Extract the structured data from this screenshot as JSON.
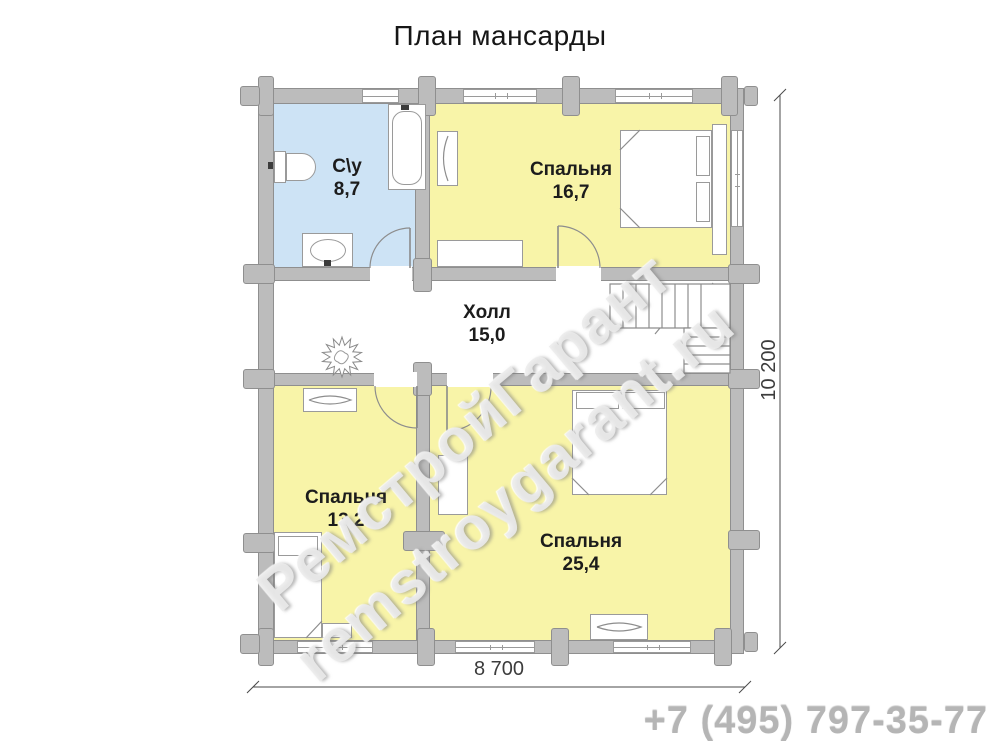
{
  "meta": {
    "title": "План мансарды",
    "phone": "+7 (495) 797-35-77"
  },
  "watermark": {
    "line1": "РемстройГарант",
    "line2": "remstroygarant.ru"
  },
  "dims": {
    "bottom": "8 700",
    "right": "10 200"
  },
  "palette": {
    "bath": "#cde3f5",
    "bedroom": "#f8f4a8",
    "hall": "#ffffff",
    "wall": "#bcbcbc",
    "wall_edge": "#8f8f8f",
    "line": "#8d8d8d",
    "dim": "#4a4a4a",
    "label": "#1c1c1c"
  },
  "floorplan": {
    "rooms": [
      {
        "name": "bathroom",
        "label": "С\\у",
        "area": "8,7",
        "x": 274,
        "y": 104,
        "w": 141,
        "h": 163,
        "fill": "bath",
        "lx": 347,
        "ly": 155
      },
      {
        "name": "bedroom-top",
        "label": "Спальня",
        "area": "16,7",
        "x": 430,
        "y": 104,
        "w": 300,
        "h": 163,
        "fill": "bedroom",
        "lx": 571,
        "ly": 158
      },
      {
        "name": "hall",
        "label": "Холл",
        "area": "15,0",
        "x": 274,
        "y": 281,
        "w": 456,
        "h": 92,
        "fill": "hall",
        "lx": 487,
        "ly": 301
      },
      {
        "name": "bedroom-left",
        "label": "Спальня",
        "area": "13,2",
        "x": 274,
        "y": 386,
        "w": 142,
        "h": 254,
        "fill": "bedroom",
        "lx": 346,
        "ly": 486
      },
      {
        "name": "bedroom-big",
        "label": "Спальня",
        "area": "25,4",
        "x": 430,
        "y": 386,
        "w": 300,
        "h": 254,
        "fill": "bedroom",
        "lx": 581,
        "ly": 530
      }
    ],
    "walls": [
      {
        "name": "wall-top",
        "x": 258,
        "y": 88,
        "w": 486,
        "h": 16
      },
      {
        "name": "wall-bottom",
        "x": 258,
        "y": 640,
        "w": 486,
        "h": 14
      },
      {
        "name": "wall-left",
        "x": 258,
        "y": 88,
        "w": 16,
        "h": 566
      },
      {
        "name": "wall-right",
        "x": 730,
        "y": 88,
        "w": 14,
        "h": 566
      },
      {
        "name": "wall-hall-top",
        "x": 274,
        "y": 267,
        "w": 456,
        "h": 14
      },
      {
        "name": "wall-hall-bottom",
        "x": 274,
        "y": 373,
        "w": 456,
        "h": 13
      },
      {
        "name": "wall-divider-top",
        "x": 415,
        "y": 104,
        "w": 15,
        "h": 163
      },
      {
        "name": "wall-divider-bottom",
        "x": 416,
        "y": 386,
        "w": 14,
        "h": 254
      }
    ],
    "crosses": [
      {
        "x": 258,
        "y": 76,
        "w": 16,
        "h": 40
      },
      {
        "x": 240,
        "y": 86,
        "w": 20,
        "h": 20
      },
      {
        "x": 418,
        "y": 76,
        "w": 18,
        "h": 40
      },
      {
        "x": 562,
        "y": 76,
        "w": 18,
        "h": 40
      },
      {
        "x": 721,
        "y": 76,
        "w": 17,
        "h": 40
      },
      {
        "x": 744,
        "y": 86,
        "w": 14,
        "h": 20
      },
      {
        "x": 243,
        "y": 264,
        "w": 32,
        "h": 20
      },
      {
        "x": 243,
        "y": 369,
        "w": 32,
        "h": 20
      },
      {
        "x": 243,
        "y": 533,
        "w": 32,
        "h": 20
      },
      {
        "x": 728,
        "y": 264,
        "w": 32,
        "h": 20
      },
      {
        "x": 728,
        "y": 369,
        "w": 32,
        "h": 20
      },
      {
        "x": 728,
        "y": 530,
        "w": 32,
        "h": 20
      },
      {
        "x": 413,
        "y": 258,
        "w": 19,
        "h": 34
      },
      {
        "x": 413,
        "y": 362,
        "w": 19,
        "h": 34
      },
      {
        "x": 403,
        "y": 531,
        "w": 42,
        "h": 20
      },
      {
        "x": 258,
        "y": 628,
        "w": 16,
        "h": 38
      },
      {
        "x": 240,
        "y": 634,
        "w": 20,
        "h": 20
      },
      {
        "x": 417,
        "y": 628,
        "w": 18,
        "h": 38
      },
      {
        "x": 551,
        "y": 628,
        "w": 18,
        "h": 38
      },
      {
        "x": 714,
        "y": 628,
        "w": 18,
        "h": 38
      },
      {
        "x": 744,
        "y": 632,
        "w": 14,
        "h": 20
      }
    ],
    "windows": [
      {
        "name": "window-top-bathroom",
        "x": 362,
        "y": 89,
        "w": 37,
        "h": 14
      },
      {
        "name": "window-top-bedroom-1",
        "x": 463,
        "y": 89,
        "w": 74,
        "h": 14
      },
      {
        "name": "window-top-bedroom-2",
        "x": 615,
        "y": 89,
        "w": 78,
        "h": 14
      },
      {
        "name": "window-right-bedroom",
        "x": 731,
        "y": 130,
        "w": 12,
        "h": 97
      },
      {
        "name": "window-bottom-left",
        "x": 297,
        "y": 641,
        "w": 76,
        "h": 12
      },
      {
        "name": "window-bottom-big-1",
        "x": 455,
        "y": 641,
        "w": 80,
        "h": 12
      },
      {
        "name": "window-bottom-big-2",
        "x": 613,
        "y": 641,
        "w": 78,
        "h": 12
      }
    ],
    "door_openings": [
      {
        "name": "bathroom-door-opening",
        "x": 370,
        "y": 266,
        "w": 42,
        "h": 16
      },
      {
        "name": "bedroom-top-door-opening",
        "x": 556,
        "y": 266,
        "w": 45,
        "h": 16
      },
      {
        "name": "bedroom-left-door-opening",
        "x": 374,
        "y": 372,
        "w": 43,
        "h": 15
      },
      {
        "name": "bedroom-big-door-opening",
        "x": 447,
        "y": 372,
        "w": 46,
        "h": 15
      }
    ],
    "furniture": [
      {
        "name": "toilet-tank",
        "x": 274,
        "y": 151,
        "w": 12,
        "h": 32
      },
      {
        "name": "toilet-bowl",
        "x": 286,
        "y": 153,
        "w": 30,
        "h": 28,
        "cls": "round-right"
      },
      {
        "name": "toilet-valve",
        "x": 268,
        "y": 162,
        "w": 5,
        "h": 7,
        "cls": "dark"
      },
      {
        "name": "bathtub",
        "x": 388,
        "y": 104,
        "w": 38,
        "h": 86
      },
      {
        "name": "bathtub-inner",
        "x": 392,
        "y": 111,
        "w": 30,
        "h": 74,
        "cls": "rounded"
      },
      {
        "name": "bathtub-tap",
        "x": 401,
        "y": 105,
        "w": 8,
        "h": 5,
        "cls": "dark"
      },
      {
        "name": "sink-cabinet",
        "x": 302,
        "y": 233,
        "w": 51,
        "h": 34
      },
      {
        "name": "sink-bowl",
        "x": 310,
        "y": 239,
        "w": 36,
        "h": 23,
        "cls": "ellipse"
      },
      {
        "name": "sink-tap",
        "x": 324,
        "y": 260,
        "w": 7,
        "h": 6,
        "cls": "dark"
      },
      {
        "name": "bedroom-top-dresser",
        "x": 437,
        "y": 131,
        "w": 21,
        "h": 55
      },
      {
        "name": "bedroom-top-cabinet",
        "x": 437,
        "y": 240,
        "w": 86,
        "h": 27
      },
      {
        "name": "bedroom-top-bed",
        "x": 620,
        "y": 130,
        "w": 92,
        "h": 98
      },
      {
        "name": "bedroom-top-pillow-1",
        "x": 696,
        "y": 136,
        "w": 14,
        "h": 40
      },
      {
        "name": "bedroom-top-pillow-2",
        "x": 696,
        "y": 182,
        "w": 14,
        "h": 40
      },
      {
        "name": "bedroom-top-headboard",
        "x": 712,
        "y": 124,
        "w": 15,
        "h": 131
      },
      {
        "name": "bedroom-left-dresser",
        "x": 303,
        "y": 388,
        "w": 54,
        "h": 24
      },
      {
        "name": "bedroom-left-bed",
        "x": 274,
        "y": 532,
        "w": 48,
        "h": 106
      },
      {
        "name": "bedroom-left-pillow",
        "x": 278,
        "y": 536,
        "w": 40,
        "h": 20
      },
      {
        "name": "bedroom-left-cabinet",
        "x": 322,
        "y": 623,
        "w": 30,
        "h": 15
      },
      {
        "name": "bedroom-big-bed",
        "x": 572,
        "y": 390,
        "w": 95,
        "h": 105
      },
      {
        "name": "bedroom-big-pillow-1",
        "x": 576,
        "y": 392,
        "w": 43,
        "h": 17
      },
      {
        "name": "bedroom-big-pillow-2",
        "x": 622,
        "y": 392,
        "w": 43,
        "h": 17
      },
      {
        "name": "bedroom-big-wardrobe",
        "x": 438,
        "y": 455,
        "w": 30,
        "h": 60
      },
      {
        "name": "bedroom-big-dresser",
        "x": 590,
        "y": 614,
        "w": 58,
        "h": 26
      }
    ],
    "svg_paths": [
      {
        "name": "bathroom-door-leaf",
        "d": "M410,268 L410,228",
        "s": "#8a8a8a",
        "w": 1.6
      },
      {
        "name": "bathroom-door-arc",
        "d": "M410,228 A40,40 0 0 0 370,268"
      },
      {
        "name": "bedroom-top-door-leaf",
        "d": "M558,268 L558,226",
        "s": "#8a8a8a",
        "w": 1.6
      },
      {
        "name": "bedroom-top-door-arc",
        "d": "M558,226 A42,42 0 0 1 600,268"
      },
      {
        "name": "bedroom-left-door-leaf",
        "d": "M417,386 L417,428",
        "s": "#8a8a8a",
        "w": 1.6
      },
      {
        "name": "bedroom-left-door-arc",
        "d": "M417,428 A42,42 0 0 1 375,386"
      },
      {
        "name": "bedroom-big-door-leaf",
        "d": "M447,386 L447,431",
        "s": "#8a8a8a",
        "w": 1.6
      },
      {
        "name": "bedroom-big-door-arc",
        "d": "M447,431 A44,44 0 0 0 491,386"
      },
      {
        "name": "bedroom-top-bed-fold-1",
        "d": "M620,150 L640,130"
      },
      {
        "name": "bedroom-top-bed-fold-2",
        "d": "M620,208 L640,228"
      },
      {
        "name": "bedroom-top-dresser-curve",
        "d": "M448,136 Q439,158 448,181"
      },
      {
        "name": "bedroom-left-bed-fold",
        "d": "M306,638 L322,621"
      },
      {
        "name": "bedroom-left-dresser-detail",
        "d": "M309,400 Q330,392 351,400 Q330,408 309,400"
      },
      {
        "name": "bedroom-big-bed-fold-1",
        "d": "M572,478 L589,495"
      },
      {
        "name": "bedroom-big-bed-fold-2",
        "d": "M667,478 L650,495"
      },
      {
        "name": "bedroom-big-dresser-detail",
        "d": "M597,627 Q619,619 641,627 Q619,635 597,627"
      },
      {
        "name": "stairs-stringer-line",
        "d": "M610,306 L660,306"
      },
      {
        "name": "stairs-break-line",
        "d": "M655,334 L679,305 L687,314 L713,283"
      },
      {
        "name": "stairs-landing-diagonal",
        "d": "M704,324 L727,292"
      },
      {
        "name": "dim-line-bottom",
        "d": "M253,687 L745,687",
        "s": "#4a4a4a",
        "w": 1
      },
      {
        "name": "dim-tick-bottom-left",
        "d": "M247,693 L259,681",
        "s": "#4a4a4a",
        "w": 1
      },
      {
        "name": "dim-tick-bottom-right",
        "d": "M739,693 L751,681",
        "s": "#4a4a4a",
        "w": 1
      },
      {
        "name": "dim-line-right",
        "d": "M780,95 L780,648",
        "s": "#4a4a4a",
        "w": 1
      },
      {
        "name": "dim-tick-right-top",
        "d": "M774,101 L786,89",
        "s": "#4a4a4a",
        "w": 1
      },
      {
        "name": "dim-tick-right-bottom",
        "d": "M774,654 L786,642",
        "s": "#4a4a4a",
        "w": 1
      }
    ],
    "stairs": {
      "upper": {
        "x": 610,
        "y": 284,
        "w": 120,
        "h": 44,
        "steps": 7,
        "stepw": 13
      },
      "lower": {
        "x": 684,
        "y": 328,
        "w": 46,
        "h": 45,
        "steps": 4,
        "steph": 9
      }
    },
    "plant": {
      "cx": 342,
      "cy": 357,
      "points": 14,
      "r1": 20,
      "r2": 12
    }
  }
}
